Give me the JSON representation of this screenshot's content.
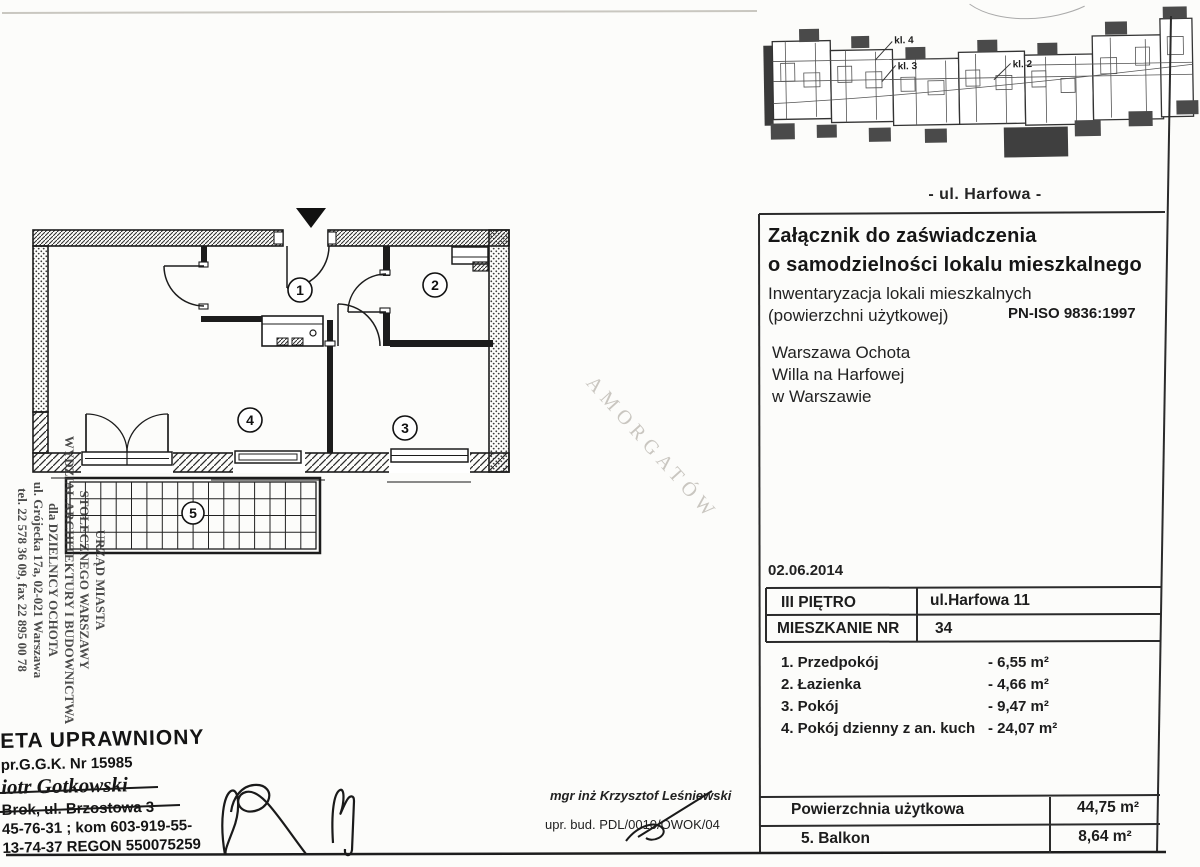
{
  "site_plan": {
    "stair_labels": [
      "kl. 4",
      "kl. 3",
      "kl. 2"
    ],
    "street_caption": "- ul. Harfowa -"
  },
  "certificate": {
    "title_line1": "Załącznik do zaświadczenia",
    "title_line2": "o samodzielności lokalu mieszkalnego",
    "subtitle_line1": "Inwentaryzacja lokali mieszkalnych",
    "subtitle_line2": "(powierzchni użytkowej)",
    "norm_code": "PN-ISO 9836:1997",
    "location_lines": [
      "Warszawa Ochota",
      "Willa na Harfowej",
      "w Warszawie"
    ],
    "date": "02.06.2014"
  },
  "info_table": {
    "rows": [
      {
        "label": "III PIĘTRO",
        "value": "ul.Harfowa 11"
      },
      {
        "label": "MIESZKANIE NR",
        "value": "34"
      }
    ]
  },
  "room_list": [
    {
      "label": "1. Przedpokój",
      "area": "-  6,55 m²"
    },
    {
      "label": "2. Łazienka",
      "area": "-  4,66 m²"
    },
    {
      "label": "3. Pokój",
      "area": "-  9,47 m²"
    },
    {
      "label": "4. Pokój dzienny z an. kuch",
      "area": "- 24,07 m²"
    }
  ],
  "summary_table": {
    "rows": [
      {
        "label": "Powierzchnia użytkowa",
        "value": "44,75 m²"
      },
      {
        "label": "5. Balkon",
        "value": "8,64 m²"
      }
    ]
  },
  "floor_plan": {
    "room_numbers": [
      "1",
      "2",
      "3",
      "4",
      "5"
    ]
  },
  "office_stamp": {
    "lines": [
      "URZĄD MIASTA",
      "STOŁECZNEGO WARSZAWY",
      "WYDZIAŁ ARCHITEKTURY I BUDOWNICTWA",
      "dla DZIELNICY OCHOTA",
      "ul. Grójecka 17a, 02-021 Warszawa",
      "tel. 22 578 36 09, fax 22 895 00 78"
    ]
  },
  "surveyor_stamp": {
    "line1": "ETA UPRAWNIONY",
    "line2": "pr.G.G.K. Nr 15985",
    "line3": "iotr Gotkowski",
    "line4": "Brok, ul. Brzostowa 3",
    "line5": "45-76-31 ; kom  603-919-55-",
    "line6": "13-74-37 REGON 550075259"
  },
  "engineer": {
    "name_line": "mgr inż Krzysztof Leśniewski",
    "license_line": "upr. bud. PDL/0010/OWOK/04"
  },
  "watermark": {
    "text": "AMORGATÓW"
  }
}
